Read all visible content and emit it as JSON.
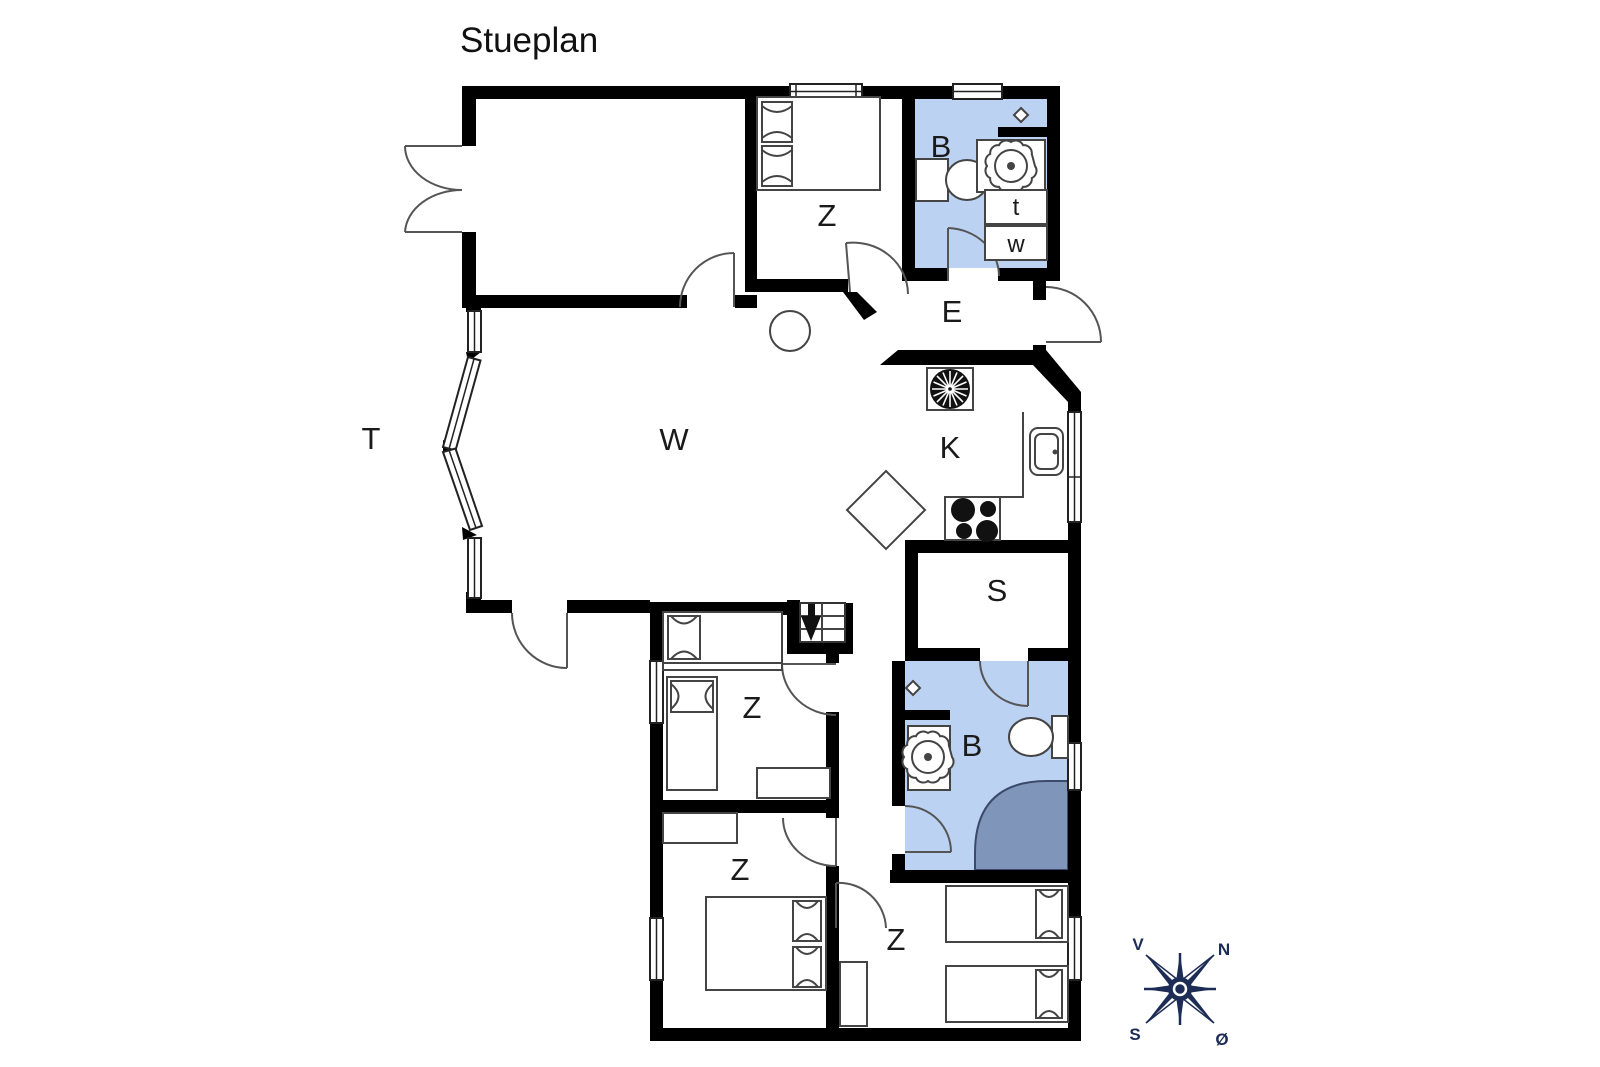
{
  "title": "Stueplan",
  "rooms": {
    "terrace": "T",
    "living": "W",
    "kitchen": "K",
    "entrance": "E",
    "sauna": "S",
    "bath_top": "B",
    "bath_bottom": "B",
    "bed_top": "Z",
    "bed_mid": "Z",
    "bed_bottom_left": "Z",
    "bed_bottom_right": "Z"
  },
  "appliances": {
    "dryer": "t",
    "washer": "w"
  },
  "compass": {
    "west": "V",
    "north": "N",
    "south": "S",
    "east": "Ø"
  },
  "colors": {
    "wall": "#000000",
    "bath_floor": "#bcd2f3",
    "shower": "#8095ba",
    "compass": "#1d2c55"
  }
}
